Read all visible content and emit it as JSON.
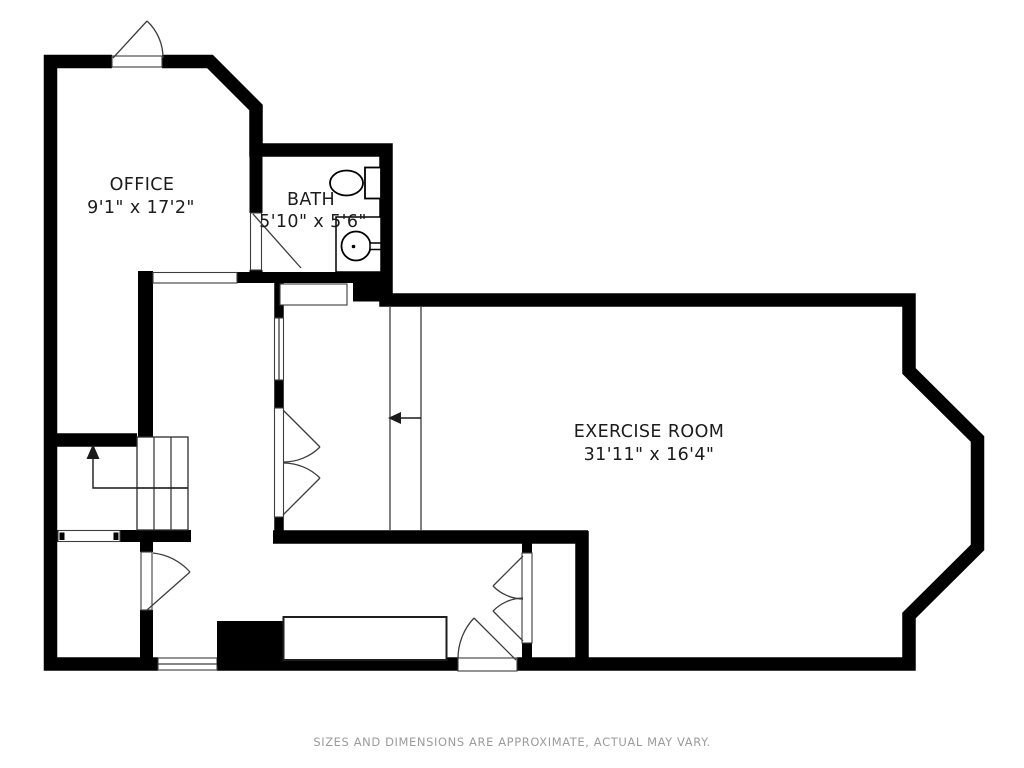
{
  "floorplan": {
    "disclaimer": "SIZES AND DIMENSIONS ARE APPROXIMATE, ACTUAL MAY VARY.",
    "rooms": [
      {
        "name": "OFFICE",
        "dimensions": "9'1\" x 17'2\""
      },
      {
        "name": "BATH",
        "dimensions": "5'10\" x 5'6\""
      },
      {
        "name": "EXERCISE ROOM",
        "dimensions": "31'11\" x 16'4\""
      }
    ],
    "fixtures": [
      "toilet-icon",
      "sink-icon",
      "stairs-icon",
      "up-arrow-icon",
      "left-arrow-icon",
      "door-swing-icon",
      "double-door-icon",
      "window-icon",
      "chimney-block",
      "built-in-cabinet"
    ],
    "colors": {
      "wall": "#000000",
      "background": "#ffffff",
      "label": "#1c1c1c",
      "disclaimer": "#9b9b9b",
      "thin_line": "#3d3d3d"
    }
  }
}
